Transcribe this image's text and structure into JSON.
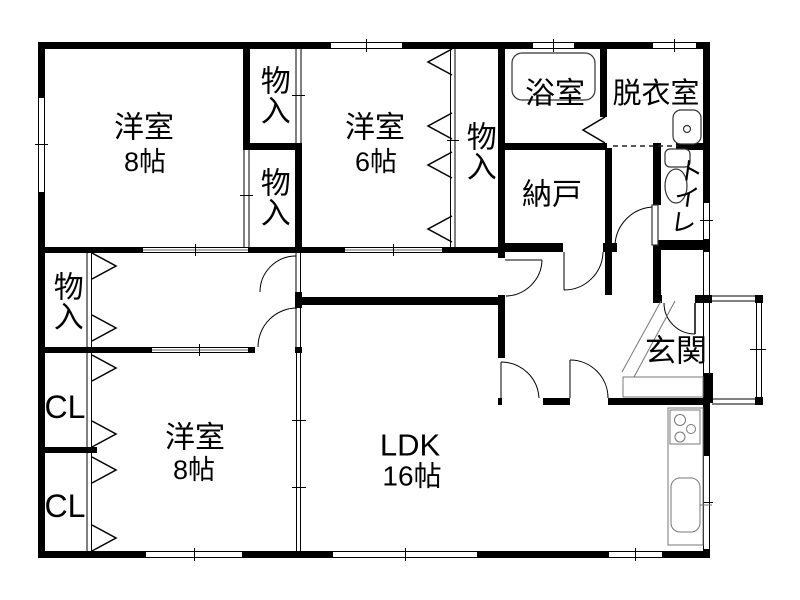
{
  "colors": {
    "wall": "#000000",
    "background": "#ffffff",
    "thin_line": "#333333",
    "gray_line": "#999999"
  },
  "rooms": {
    "bedroom_nw": {
      "name": "洋室",
      "size": "8帖"
    },
    "bedroom_n": {
      "name": "洋室",
      "size": "6帖"
    },
    "bedroom_sw": {
      "name": "洋室",
      "size": "8帖"
    },
    "ldk": {
      "name": "LDK",
      "size": "16帖"
    },
    "bath": {
      "name": "浴室"
    },
    "dressing_room": {
      "name": "脱衣室"
    },
    "storage_room": {
      "name": "納戸"
    },
    "toilet": {
      "name": "トイレ"
    },
    "entrance": {
      "name": "玄関"
    },
    "closet_top_1": {
      "name": "物入"
    },
    "closet_top_2": {
      "name": "物入"
    },
    "closet_mid": {
      "name": "物入"
    },
    "closet_west": {
      "name": "物入"
    },
    "closet_cl_1": {
      "name": "CL"
    },
    "closet_cl_2": {
      "name": "CL"
    }
  }
}
